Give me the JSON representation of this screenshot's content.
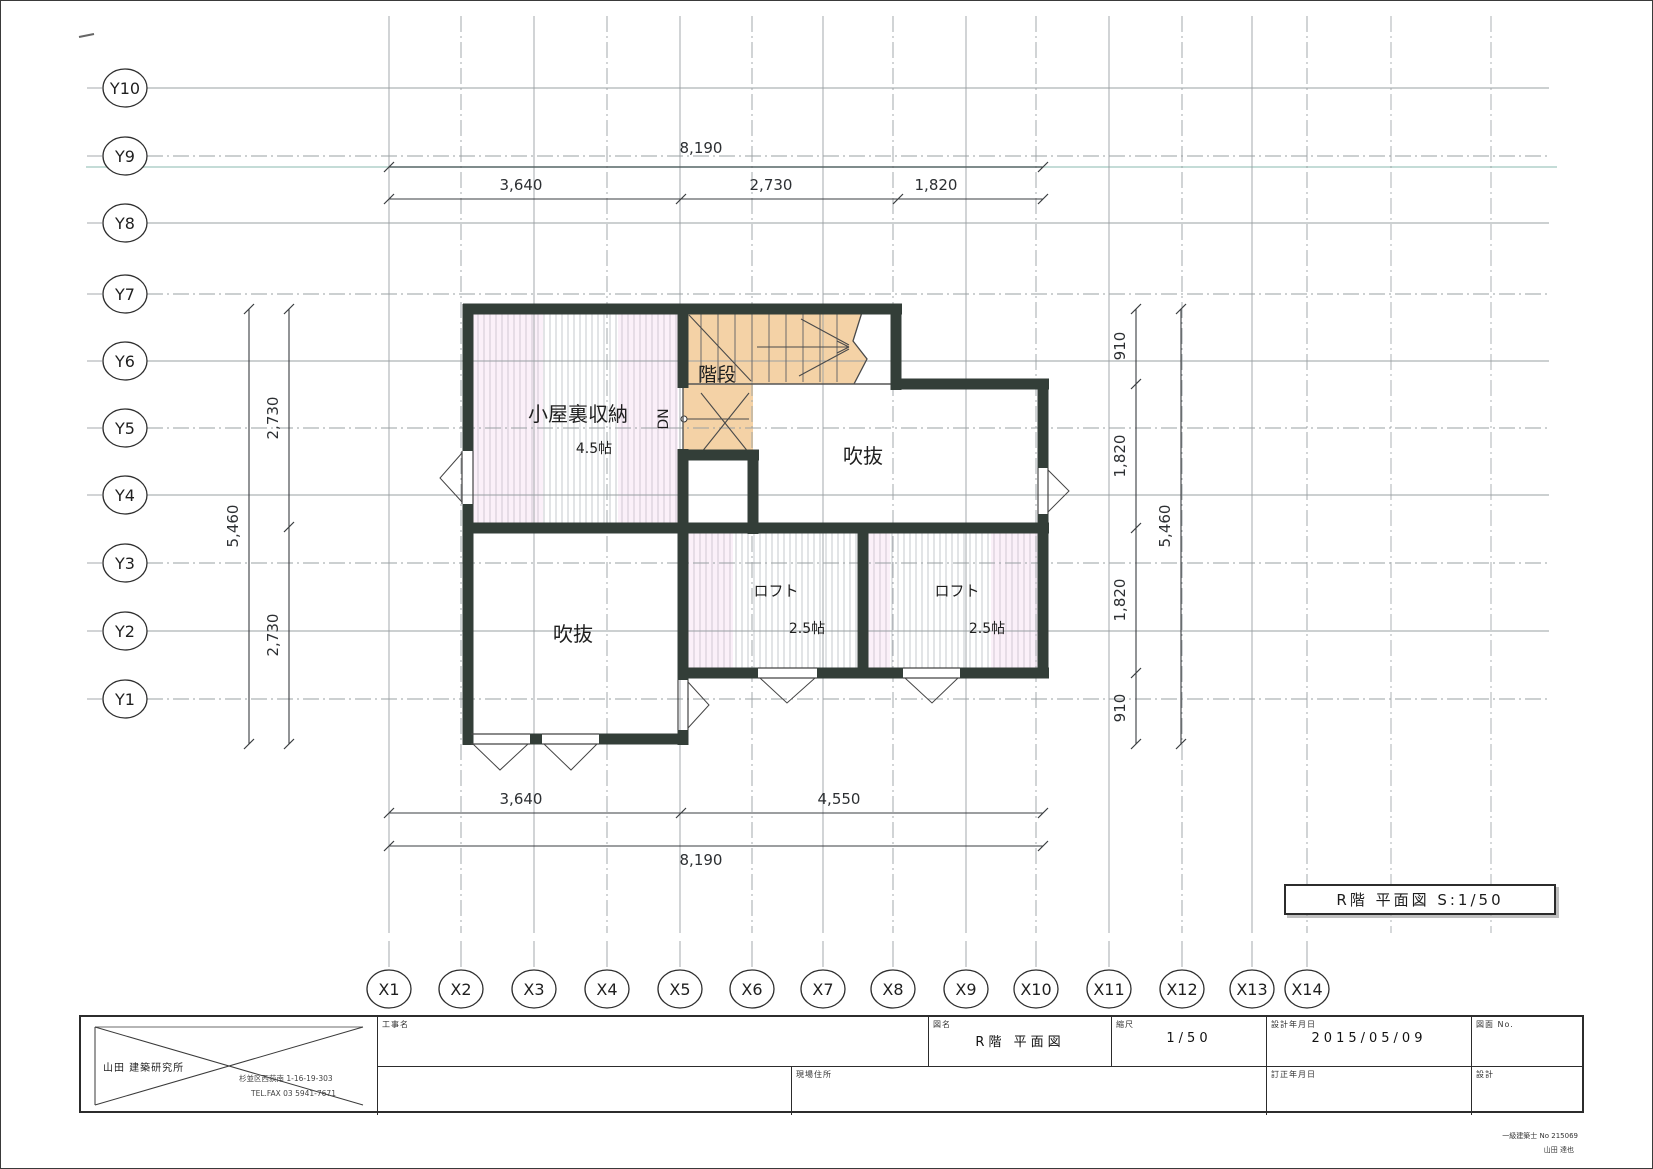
{
  "figure_label": {
    "text": "R階  平面図  S:1/50"
  },
  "title_block": {
    "company": "山田  建築研究所",
    "address_line1": "杉並区西荻南 1-16-19-303",
    "address_line2": "TEL.FAX 03 5941-7671",
    "koji_label": "工事名",
    "zumei_label": "図名",
    "zumei_value": "R階  平面図",
    "scale_label": "縮尺",
    "scale_value": "1/50",
    "date_label": "設計年月日",
    "date_value": "2015/05/09",
    "zumen_no_label": "図面  No.",
    "genba_label": "現場住所",
    "teisei_label": "訂正年月日",
    "sekkei_label": "設計",
    "sekkei_line1": "一級建築士 No 215069",
    "sekkei_line2": "山田 達也"
  },
  "plan": {
    "colors": {
      "wall": "#333e38",
      "stair_fill": "#f4d2a6",
      "hatch": "#c6c8cc",
      "pink": "#f0c8e8",
      "grid": "#9aa0a3",
      "dim": "#3a3d40",
      "teal": "#7eb2a8",
      "thin": "#555555",
      "label": "#1f1f1f"
    },
    "grid": {
      "y_axes": [
        {
          "label": "Y10",
          "y": 87
        },
        {
          "label": "Y9",
          "y": 155
        },
        {
          "label": "Y8",
          "y": 222
        },
        {
          "label": "Y7",
          "y": 293
        },
        {
          "label": "Y6",
          "y": 360
        },
        {
          "label": "Y5",
          "y": 427
        },
        {
          "label": "Y4",
          "y": 494
        },
        {
          "label": "Y3",
          "y": 562
        },
        {
          "label": "Y2",
          "y": 630
        },
        {
          "label": "Y1",
          "y": 698
        }
      ],
      "x_axes": [
        {
          "label": "X1",
          "x": 388
        },
        {
          "label": "X2",
          "x": 460
        },
        {
          "label": "X3",
          "x": 533
        },
        {
          "label": "X4",
          "x": 606
        },
        {
          "label": "X5",
          "x": 679
        },
        {
          "label": "X6",
          "x": 751
        },
        {
          "label": "X7",
          "x": 822
        },
        {
          "label": "X8",
          "x": 892
        },
        {
          "label": "X9",
          "x": 965
        },
        {
          "label": "X10",
          "x": 1035
        },
        {
          "label": "X11",
          "x": 1108
        },
        {
          "label": "X12",
          "x": 1181
        },
        {
          "label": "X13",
          "x": 1251
        },
        {
          "label": "X14",
          "x": 1306
        }
      ],
      "extra_v_lines": [
        1390,
        1490
      ],
      "h_extent": [
        148,
        1548
      ],
      "v_extent": [
        15,
        932
      ],
      "bubble_x": 124,
      "bubble_y": 988
    },
    "hatch_regions": [
      {
        "x": 472,
        "y": 313,
        "w": 205,
        "h": 209
      },
      {
        "x": 687,
        "y": 532,
        "w": 170,
        "h": 135
      },
      {
        "x": 867,
        "y": 532,
        "w": 170,
        "h": 135
      }
    ],
    "pink_patches": [
      {
        "x": 472,
        "y": 313,
        "w": 70,
        "h": 209
      },
      {
        "x": 617,
        "y": 313,
        "w": 60,
        "h": 209
      },
      {
        "x": 687,
        "y": 532,
        "w": 45,
        "h": 135
      },
      {
        "x": 990,
        "y": 532,
        "w": 47,
        "h": 135
      },
      {
        "x": 867,
        "y": 532,
        "w": 22,
        "h": 135
      }
    ],
    "stair": {
      "polygon": "682,308 862,308 852,340 866,358 853,383 752,383 752,454 682,454",
      "tread_xs": [
        700,
        717,
        734,
        751,
        768,
        785,
        802,
        819,
        836
      ],
      "tread_y1": 310,
      "tread_y2": 381,
      "lines": [
        [
          688,
          314,
          750,
          380
        ],
        [
          700,
          392,
          748,
          452
        ],
        [
          748,
          392,
          700,
          452
        ],
        [
          682,
          418,
          748,
          418
        ],
        [
          800,
          318,
          848,
          344
        ],
        [
          798,
          375,
          848,
          348
        ],
        [
          756,
          346,
          848,
          346
        ],
        [
          848,
          346,
          836,
          340
        ],
        [
          848,
          346,
          836,
          352
        ]
      ],
      "zigzag": "862,308 852,340 866,358 853,383",
      "dn_circle": {
        "cx": 683,
        "cy": 418,
        "r": 3
      }
    },
    "walls": [
      [
        462,
        308,
        901,
        308
      ],
      [
        467,
        303,
        467,
        450
      ],
      [
        467,
        503,
        467,
        744
      ],
      [
        682,
        303,
        682,
        387
      ],
      [
        682,
        448,
        682,
        679
      ],
      [
        682,
        729,
        682,
        744
      ],
      [
        893,
        383,
        1048,
        383
      ],
      [
        895,
        303,
        895,
        389
      ],
      [
        677,
        454,
        758,
        454
      ],
      [
        752,
        449,
        752,
        533
      ],
      [
        462,
        527,
        1048,
        527
      ],
      [
        677,
        672,
        757,
        672
      ],
      [
        816,
        672,
        902,
        672
      ],
      [
        959,
        672,
        1048,
        672
      ],
      [
        1042,
        378,
        1042,
        467
      ],
      [
        1042,
        513,
        1042,
        677
      ],
      [
        862,
        532,
        862,
        667
      ],
      [
        462,
        738,
        472,
        738
      ],
      [
        529,
        738,
        541,
        738
      ],
      [
        598,
        738,
        687,
        738
      ]
    ],
    "thin_lines": [
      [
        682,
        387,
        682,
        448
      ],
      [
        682,
        383,
        893,
        383
      ]
    ],
    "windows": [
      {
        "lines": [
          [
            461,
            450,
            461,
            503
          ],
          [
            472,
            450,
            472,
            503
          ]
        ],
        "tri": "461,452 439,477 461,501"
      },
      {
        "lines": [
          [
            677,
            679,
            677,
            729
          ],
          [
            687,
            679,
            687,
            729
          ]
        ],
        "tri": "687,681 708,704 687,727"
      },
      {
        "lines": [
          [
            1037,
            467,
            1037,
            513
          ],
          [
            1047,
            467,
            1047,
            513
          ]
        ],
        "tri": "1047,469 1068,490 1047,511"
      },
      {
        "lines": [
          [
            757,
            667,
            816,
            667
          ],
          [
            757,
            677,
            816,
            677
          ]
        ],
        "tri": "759,677 786,702 814,677"
      },
      {
        "lines": [
          [
            902,
            667,
            959,
            667
          ],
          [
            902,
            677,
            959,
            677
          ]
        ],
        "tri": "904,677 931,702 957,677"
      },
      {
        "lines": [
          [
            470,
            733,
            529,
            733
          ],
          [
            470,
            743,
            529,
            743
          ]
        ],
        "tri": "472,743 499,769 527,743"
      },
      {
        "lines": [
          [
            541,
            733,
            598,
            733
          ],
          [
            541,
            743,
            598,
            743
          ]
        ],
        "tri": "543,743 570,769 596,743"
      }
    ],
    "room_labels": [
      {
        "text": "小屋裏収納",
        "x": 577,
        "y": 420,
        "fs": 20,
        "rot": 0
      },
      {
        "text": "4.5帖",
        "x": 593,
        "y": 452,
        "fs": 14,
        "rot": 0
      },
      {
        "text": "階段",
        "x": 716,
        "y": 380,
        "fs": 19,
        "rot": 0
      },
      {
        "text": "DN",
        "x": 667,
        "y": 418,
        "fs": 14,
        "rot": -90
      },
      {
        "text": "吹抜",
        "x": 862,
        "y": 462,
        "fs": 20,
        "rot": 0
      },
      {
        "text": "吹抜",
        "x": 572,
        "y": 640,
        "fs": 20,
        "rot": 0
      },
      {
        "text": "ロフト",
        "x": 775,
        "y": 595,
        "fs": 15,
        "rot": 0
      },
      {
        "text": "2.5帖",
        "x": 806,
        "y": 632,
        "fs": 14,
        "rot": 0
      },
      {
        "text": "ロフト",
        "x": 956,
        "y": 595,
        "fs": 15,
        "rot": 0
      },
      {
        "text": "2.5帖",
        "x": 986,
        "y": 632,
        "fs": 14,
        "rot": 0
      }
    ],
    "dimensions": [
      {
        "orient": "h",
        "line": 166,
        "from": 388,
        "to": 1042,
        "ticks": [
          388,
          1042
        ],
        "labels": [
          {
            "text": "8,190",
            "x": 700,
            "y": 152
          }
        ]
      },
      {
        "orient": "h",
        "line": 198,
        "from": 388,
        "to": 1042,
        "ticks": [
          388,
          680,
          897,
          1042
        ],
        "labels": [
          {
            "text": "3,640",
            "x": 520,
            "y": 189
          },
          {
            "text": "2,730",
            "x": 770,
            "y": 189
          },
          {
            "text": "1,820",
            "x": 935,
            "y": 189
          }
        ]
      },
      {
        "orient": "h",
        "line": 812,
        "from": 388,
        "to": 1042,
        "ticks": [
          388,
          680,
          1042
        ],
        "labels": [
          {
            "text": "3,640",
            "x": 520,
            "y": 803
          },
          {
            "text": "4,550",
            "x": 838,
            "y": 803
          }
        ]
      },
      {
        "orient": "h",
        "line": 845,
        "from": 388,
        "to": 1042,
        "ticks": [
          388,
          1042
        ],
        "labels": [
          {
            "text": "8,190",
            "x": 700,
            "y": 864
          }
        ]
      },
      {
        "orient": "v",
        "line": 288,
        "from": 308,
        "to": 743,
        "ticks": [
          308,
          526,
          743
        ],
        "labels": [
          {
            "text": "2,730",
            "x": 277,
            "y": 417
          },
          {
            "text": "2,730",
            "x": 277,
            "y": 634
          }
        ]
      },
      {
        "orient": "v",
        "line": 248,
        "from": 308,
        "to": 743,
        "ticks": [
          308,
          743
        ],
        "labels": [
          {
            "text": "5,460",
            "x": 237,
            "y": 525
          }
        ]
      },
      {
        "orient": "v",
        "line": 1135,
        "from": 308,
        "to": 743,
        "ticks": [
          308,
          383,
          527,
          672,
          743
        ],
        "labels": [
          {
            "text": "910",
            "x": 1124,
            "y": 345
          },
          {
            "text": "1,820",
            "x": 1124,
            "y": 455
          },
          {
            "text": "1,820",
            "x": 1124,
            "y": 599
          },
          {
            "text": "910",
            "x": 1124,
            "y": 707
          }
        ]
      },
      {
        "orient": "v",
        "line": 1180,
        "from": 308,
        "to": 743,
        "ticks": [
          308,
          743
        ],
        "labels": [
          {
            "text": "5,460",
            "x": 1169,
            "y": 525
          }
        ]
      }
    ]
  }
}
